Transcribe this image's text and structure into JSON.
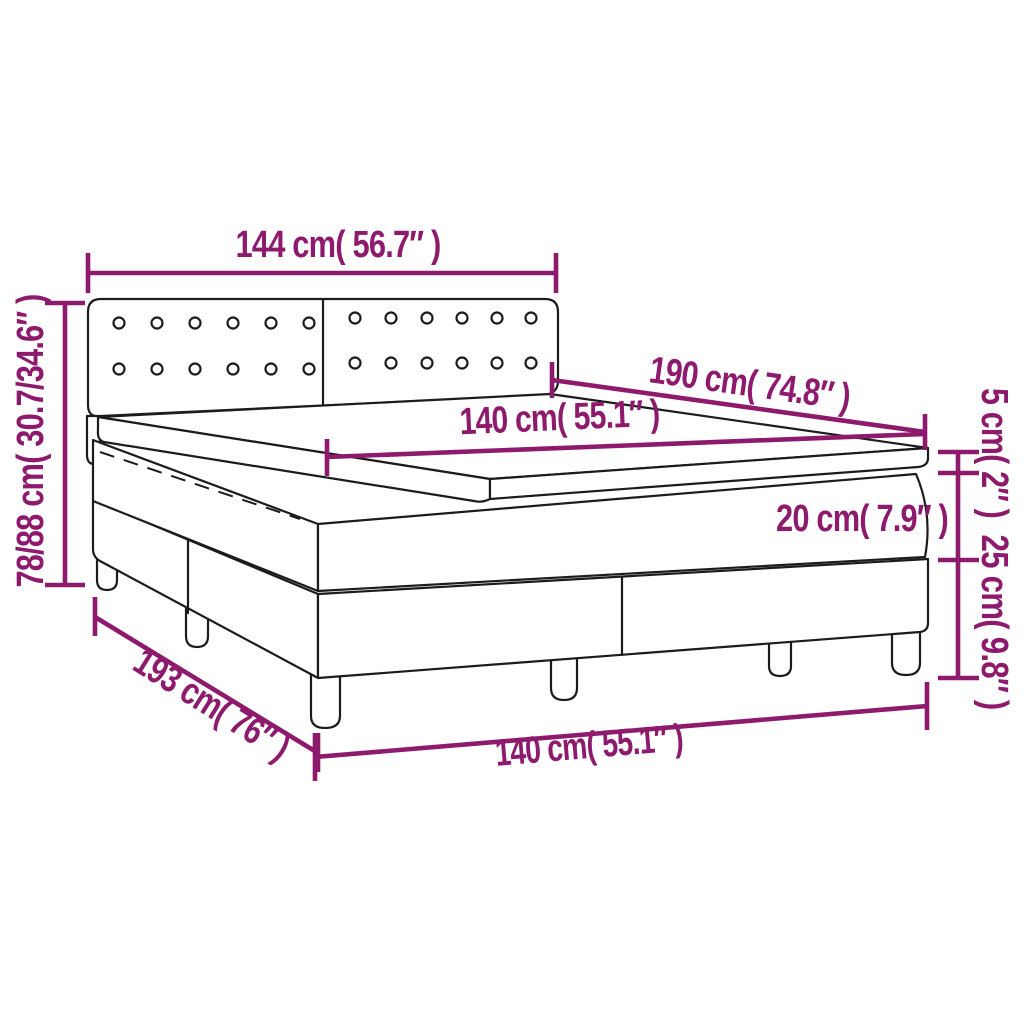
{
  "diagram": {
    "type": "product-dimension-diagram",
    "subject": "box spring bed with headboard, mattress and topper",
    "accent_color": "#8e1a6d",
    "outline_color": "#1c1c1c",
    "background_color": "#ffffff",
    "labels": {
      "headboard_width": "144 cm( 56.7″ )",
      "bed_height": "78/88 cm( 30.7/34.6″ )",
      "mattress_length": "190 cm( 74.8″ )",
      "mattress_width_top": "140 cm( 55.1″ )",
      "topper_height": "5 cm( 2″ )",
      "mattress_height": "20 cm( 7.9″ )",
      "base_height": "25 cm( 9.8″ )",
      "base_length": "193 cm( 76″ )",
      "base_width_bottom": "140 cm( 55.1″ )"
    }
  }
}
